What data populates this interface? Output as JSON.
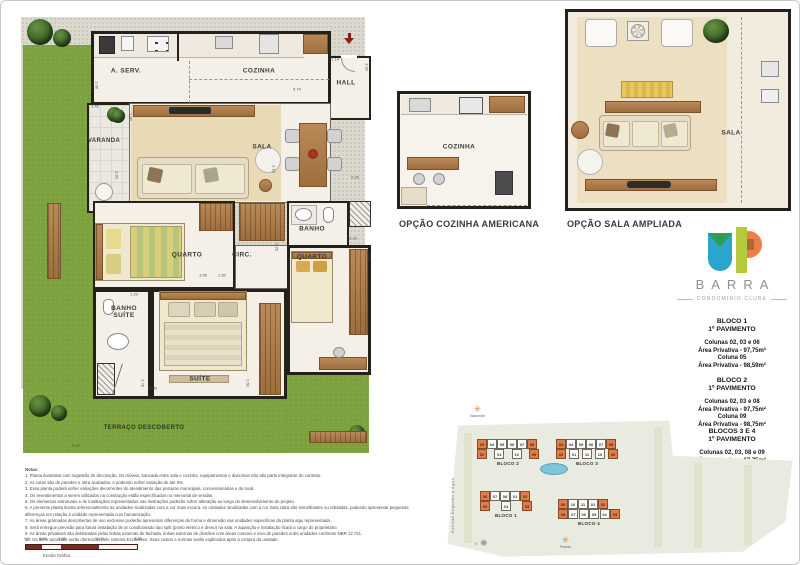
{
  "main_plan": {
    "rooms": {
      "a_serv": "A. SERV.",
      "cozinha": "COZINHA",
      "hall": "HALL",
      "varanda": "VARANDA",
      "sala": "SALA",
      "banho": "BANHO",
      "quarto1": "QUARTO",
      "circ": "CIRC.",
      "quarto2": "QUARTO",
      "banho_suite": "BANHO SUÍTE",
      "suite": "SUÍTE",
      "terraco": "TERRAÇO DESCOBERTO"
    },
    "dims": {
      "hall_w": "1.14",
      "hall_h": "3.20",
      "cozinha_w": "5.74",
      "aserv_h": "1.08",
      "varanda_w": "1.42",
      "varanda_h1": "2.40",
      "varanda_h2": "2.20",
      "sala_h": "2.15",
      "sala_e": "0.20",
      "banho_h": "2.25",
      "quarto2_w": "2.23",
      "quarto2_h": "3.15",
      "quarto1_w1": "3.05",
      "quarto1_w2": "1.50",
      "banho_suite_w": "1.23",
      "suite_h1": "2.78",
      "suite_w": "3.30",
      "suite_h2": "2.60",
      "terraco_w": "6.92"
    }
  },
  "options": {
    "kitchen": {
      "title": "OPÇÃO COZINHA AMERICANA",
      "room": "COZINHA"
    },
    "sala": {
      "title": "OPÇÃO SALA AMPLIADA",
      "room": "SALA"
    }
  },
  "logo": {
    "name": "BARRA",
    "tagline": "CONDOMÍNIO CLUBE",
    "colors": {
      "blue": "#2aa5cd",
      "green": "#2f9e52",
      "lime": "#b5c93d",
      "orange": "#ee7d45",
      "brown": "#aa6a38"
    }
  },
  "info": {
    "bloco1": {
      "title": "BLOCO 1",
      "subtitle": "1º PAVIMENTO",
      "l1": "Colunas 02, 03 e 06",
      "l2": "Área Privativa - 97,75m²",
      "l3": "Coluna 05",
      "l4": "Área Privativa - 98,59m²"
    },
    "bloco2": {
      "title": "BLOCO 2",
      "subtitle": "1º PAVIMENTO",
      "l1": "Colunas 02, 03 e 08",
      "l2": "Área Privativa - 97,75m²",
      "l3": "Coluna 09",
      "l4": "Área Privativa - 98,75m²"
    },
    "bloco34": {
      "title": "BLOCOS 3 E 4",
      "subtitle": "1º PAVIMENTO",
      "l1": "Colunas 02, 03, 08 e 09",
      "l2": "Área Privativa - 97,75m²"
    }
  },
  "site_map": {
    "street": "Estrada Engenho d'Água",
    "sun_east": "Nascente",
    "sun_west": "Poente",
    "compass": "N",
    "b2": {
      "name": "BLOCO 2",
      "top": [
        {
          "n": "03",
          "cls": "hl"
        },
        {
          "n": "04"
        },
        {
          "n": "05"
        },
        {
          "n": "06"
        },
        {
          "n": "07"
        },
        {
          "n": "08",
          "cls": "hl"
        }
      ],
      "bottom": [
        {
          "n": "02",
          "cls": "hl"
        },
        {
          "n": "01"
        },
        {
          "n": "10"
        },
        {
          "n": "09",
          "cls": "hl"
        }
      ]
    },
    "b3": {
      "name": "BLOCO 3",
      "top": [
        {
          "n": "03",
          "cls": "hl"
        },
        {
          "n": "04"
        },
        {
          "n": "05"
        },
        {
          "n": "06"
        },
        {
          "n": "07"
        },
        {
          "n": "08",
          "cls": "hl"
        }
      ],
      "bottom": [
        {
          "n": "02",
          "cls": "hl"
        },
        {
          "n": "01"
        },
        {
          "n": "11"
        },
        {
          "n": "10"
        },
        {
          "n": "09",
          "cls": "hl"
        }
      ]
    },
    "b1": {
      "name": "BLOCO 1",
      "top": [
        {
          "n": "06",
          "cls": "hl"
        },
        {
          "n": "07"
        },
        {
          "n": "08"
        },
        {
          "n": "01"
        },
        {
          "n": "02",
          "cls": "hl"
        }
      ],
      "bottom": [
        {
          "n": "05",
          "cls": "hl"
        },
        {
          "n": "04"
        },
        {
          "n": "03",
          "cls": "hl"
        }
      ]
    },
    "b4": {
      "name": "BLOCO 4",
      "top": [
        {
          "n": "09",
          "cls": "hl"
        },
        {
          "n": "10"
        },
        {
          "n": "11"
        },
        {
          "n": "01"
        },
        {
          "n": "02",
          "cls": "hl"
        }
      ],
      "bottom": [
        {
          "n": "08",
          "cls": "hl"
        },
        {
          "n": "07"
        },
        {
          "n": "06"
        },
        {
          "n": "05"
        },
        {
          "n": "04"
        },
        {
          "n": "03",
          "cls": "hl"
        }
      ]
    }
  },
  "notes": {
    "title": "Notas:",
    "items": [
      "1. Planta ilustrativa com sugestão de decoração. Os móveis, bancada entre sala e cozinha, equipamentos e divisórias não são parte integrante do contrato.",
      "2. As cotas são de paredes e obra acabados, e podendo sofrer variação de até 5%.",
      "3. Essa planta poderá sofrer variações decorrentes do atendimento das posturas municipais, concessionárias e do local.",
      "4. Os revestimentos a serem utilizados na construção estão especificados no memorial de vendas.",
      "5. Os elementos estruturais e de instalações representados nas ilustrações poderão sofrer alteração ao longo do desenvolvimento do projeto.",
      "6. A presente planta ilustra referencialmente as unidades sinalizadas com a cor mais escura. As unidades sinalizadas com a cor mais clara são semelhantes ou rebatidas, podendo apresentar pequenas diferenças em relação a unidade representada com humanização.",
      "7. As áreas gramadas descobertas de uso exclusivo poderão apresentar diferenças de forma e dimensão nas unidades específicas da planta aqui representada.",
      "8. Será entregue previsão para futura instalação de ar condicionado tipo split (ponto elétrico e dreno) na sala. A aquisição e instalação ficará a cargo do proprietário.",
      "9. As áreas privativas são delimitadas pelas linhas externas de fachada, linhas externas de divisões com áreas comuns e eixo de paredes entre unidades conforme NBR 12.721.",
      "10. Os itens opcionais serão oferecidos pelo sistema Exclusiven. Seus custos e normas serão explicados após a compra da unidade."
    ]
  },
  "scale": {
    "ticks": [
      "0,0",
      "0,50",
      "1,00",
      "2,00",
      "3,00"
    ],
    "label": "Escala Gráfica"
  }
}
